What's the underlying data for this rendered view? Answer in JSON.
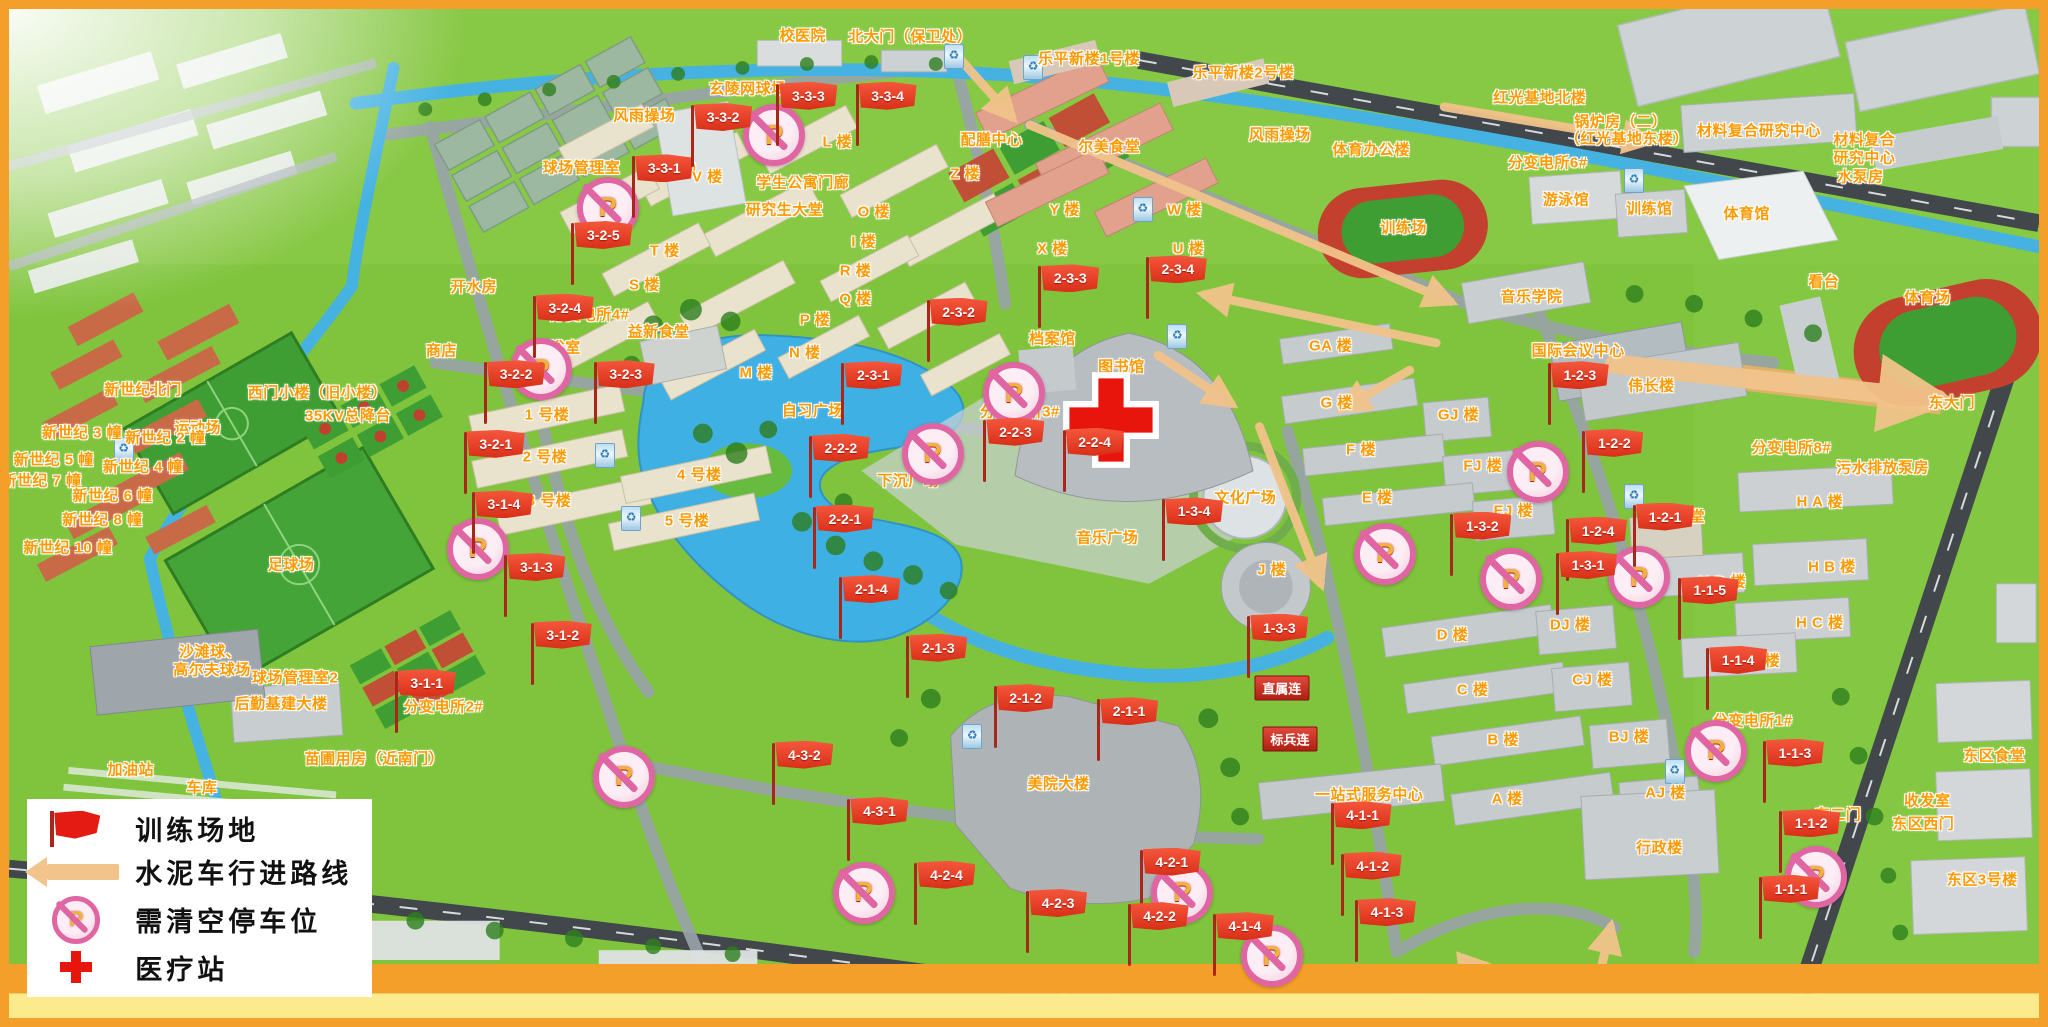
{
  "legend": {
    "items": [
      {
        "icon": "flag-icon",
        "label": "训练场地"
      },
      {
        "icon": "arrow-icon",
        "label": "水泥车行进路线"
      },
      {
        "icon": "no-parking-icon",
        "label": "需清空停车位"
      },
      {
        "icon": "medical-cross-icon",
        "label": "医疗站"
      }
    ]
  },
  "colors": {
    "flag_red": "#e0371f",
    "arrow_tan": "#f2c38b",
    "no_parking_pink": "#df66a2",
    "medical_red": "#e8150d",
    "label_orange": "#ff9a00",
    "frame_orange": "#f59f2b"
  },
  "map": {
    "flags": [
      {
        "id": "3-3-1",
        "x": 30.9,
        "y": 15.9
      },
      {
        "id": "3-3-2",
        "x": 33.8,
        "y": 10.8
      },
      {
        "id": "3-3-3",
        "x": 38.0,
        "y": 8.7
      },
      {
        "id": "3-3-4",
        "x": 41.9,
        "y": 8.7
      },
      {
        "id": "3-2-1",
        "x": 22.6,
        "y": 43.2
      },
      {
        "id": "3-2-2",
        "x": 23.6,
        "y": 36.3
      },
      {
        "id": "3-2-3",
        "x": 29.0,
        "y": 36.3
      },
      {
        "id": "3-2-4",
        "x": 26.0,
        "y": 29.7
      },
      {
        "id": "3-2-5",
        "x": 27.9,
        "y": 22.5
      },
      {
        "id": "3-1-1",
        "x": 19.2,
        "y": 66.9
      },
      {
        "id": "3-1-2",
        "x": 25.9,
        "y": 62.1
      },
      {
        "id": "3-1-3",
        "x": 24.6,
        "y": 55.4
      },
      {
        "id": "3-1-4",
        "x": 23.0,
        "y": 49.2
      },
      {
        "id": "2-3-1",
        "x": 41.2,
        "y": 36.4
      },
      {
        "id": "2-3-2",
        "x": 45.4,
        "y": 30.1
      },
      {
        "id": "2-3-3",
        "x": 50.9,
        "y": 26.8
      },
      {
        "id": "2-3-4",
        "x": 56.2,
        "y": 25.9
      },
      {
        "id": "2-2-1",
        "x": 39.8,
        "y": 50.6
      },
      {
        "id": "2-2-2",
        "x": 39.6,
        "y": 43.6
      },
      {
        "id": "2-2-3",
        "x": 48.2,
        "y": 42.0
      },
      {
        "id": "2-2-4",
        "x": 52.1,
        "y": 43.0
      },
      {
        "id": "2-1-1",
        "x": 53.8,
        "y": 69.7
      },
      {
        "id": "2-1-2",
        "x": 48.7,
        "y": 68.4
      },
      {
        "id": "2-1-3",
        "x": 44.4,
        "y": 63.4
      },
      {
        "id": "2-1-4",
        "x": 41.1,
        "y": 57.6
      },
      {
        "id": "1-2-1",
        "x": 80.2,
        "y": 50.4
      },
      {
        "id": "1-2-2",
        "x": 77.7,
        "y": 43.1
      },
      {
        "id": "1-2-3",
        "x": 76.0,
        "y": 36.4
      },
      {
        "id": "1-2-4",
        "x": 76.9,
        "y": 51.8
      },
      {
        "id": "1-3-1",
        "x": 76.4,
        "y": 55.2
      },
      {
        "id": "1-3-2",
        "x": 71.2,
        "y": 51.3
      },
      {
        "id": "1-3-3",
        "x": 61.2,
        "y": 61.4
      },
      {
        "id": "1-3-4",
        "x": 57.0,
        "y": 49.9
      },
      {
        "id": "1-1-1",
        "x": 86.4,
        "y": 87.3
      },
      {
        "id": "1-1-2",
        "x": 87.4,
        "y": 80.8
      },
      {
        "id": "1-1-3",
        "x": 86.6,
        "y": 73.8
      },
      {
        "id": "1-1-4",
        "x": 83.8,
        "y": 64.6
      },
      {
        "id": "1-1-5",
        "x": 82.4,
        "y": 57.7
      },
      {
        "id": "4-1-1",
        "x": 65.3,
        "y": 80.0
      },
      {
        "id": "4-1-2",
        "x": 65.8,
        "y": 85.0
      },
      {
        "id": "4-1-3",
        "x": 66.5,
        "y": 89.6
      },
      {
        "id": "4-1-4",
        "x": 59.5,
        "y": 91.0
      },
      {
        "id": "4-2-1",
        "x": 55.9,
        "y": 84.6
      },
      {
        "id": "4-2-2",
        "x": 55.3,
        "y": 90.0
      },
      {
        "id": "4-2-3",
        "x": 50.3,
        "y": 88.7
      },
      {
        "id": "4-2-4",
        "x": 44.8,
        "y": 85.9
      },
      {
        "id": "4-3-1",
        "x": 41.5,
        "y": 79.6
      },
      {
        "id": "4-3-2",
        "x": 37.8,
        "y": 74.0
      }
    ],
    "labels": [
      {
        "text": "校医院",
        "x": 39.1,
        "y": 2.6
      },
      {
        "text": "北大门（保卫处）",
        "x": 44.4,
        "y": 2.7
      },
      {
        "text": "乐平新楼1号楼",
        "x": 53.2,
        "y": 4.9
      },
      {
        "text": "乐平新楼2号楼",
        "x": 60.8,
        "y": 6.2
      },
      {
        "text": "红光基地北楼",
        "x": 75.4,
        "y": 8.7
      },
      {
        "text": "锅炉房（二）",
        "x": 79.4,
        "y": 11.1
      },
      {
        "text": "（红光基地东楼）",
        "x": 79.7,
        "y": 12.8
      },
      {
        "text": "材料复合研究中心",
        "x": 86.2,
        "y": 12.0
      },
      {
        "text": "材料复合",
        "x": 91.4,
        "y": 12.9
      },
      {
        "text": "研究中心",
        "x": 91.4,
        "y": 14.7
      },
      {
        "text": "水泵房",
        "x": 91.2,
        "y": 16.6
      },
      {
        "text": "玄陵网球场",
        "x": 36.4,
        "y": 7.8
      },
      {
        "text": "水泵房",
        "x": 39.3,
        "y": 8.6
      },
      {
        "text": "2#",
        "x": 43.0,
        "y": 8.4
      },
      {
        "text": "风雨操场",
        "x": 31.3,
        "y": 10.5
      },
      {
        "text": "风雨操场",
        "x": 62.6,
        "y": 12.4
      },
      {
        "text": "体育办公楼",
        "x": 67.1,
        "y": 13.9
      },
      {
        "text": "配膳中心",
        "x": 48.4,
        "y": 12.9
      },
      {
        "text": "尔美食堂",
        "x": 54.2,
        "y": 13.6
      },
      {
        "text": "训练场",
        "x": 68.7,
        "y": 21.6
      },
      {
        "text": "游泳馆",
        "x": 76.7,
        "y": 18.8
      },
      {
        "text": "训练馆",
        "x": 80.8,
        "y": 19.7
      },
      {
        "text": "体育馆",
        "x": 85.6,
        "y": 20.2
      },
      {
        "text": "看台",
        "x": 89.4,
        "y": 27.0
      },
      {
        "text": "体育场",
        "x": 94.5,
        "y": 28.5
      },
      {
        "text": "分变电所6#",
        "x": 75.8,
        "y": 15.2
      },
      {
        "text": "学生公寓门廊",
        "x": 39.1,
        "y": 17.1
      },
      {
        "text": "研究生大堂",
        "x": 38.2,
        "y": 19.8
      },
      {
        "text": "球场管理室",
        "x": 28.2,
        "y": 15.7
      },
      {
        "text": "（球馆）",
        "x": 32.8,
        "y": 15.8
      },
      {
        "text": "开水房",
        "x": 22.9,
        "y": 27.5
      },
      {
        "text": "分变电所4#",
        "x": 28.6,
        "y": 30.2
      },
      {
        "text": "商店",
        "x": 21.3,
        "y": 33.8
      },
      {
        "text": "浴室",
        "x": 27.4,
        "y": 33.5
      },
      {
        "text": "益新食堂",
        "x": 32.0,
        "y": 31.9
      },
      {
        "text": "L 楼",
        "x": 40.8,
        "y": 13.1
      },
      {
        "text": "V 楼",
        "x": 34.4,
        "y": 16.6
      },
      {
        "text": "Z 楼",
        "x": 47.1,
        "y": 16.3
      },
      {
        "text": "Y 楼",
        "x": 52.0,
        "y": 19.8
      },
      {
        "text": "X 楼",
        "x": 51.4,
        "y": 23.7
      },
      {
        "text": "W 楼",
        "x": 57.9,
        "y": 19.8
      },
      {
        "text": "U 楼",
        "x": 58.1,
        "y": 23.7
      },
      {
        "text": "O 楼",
        "x": 42.6,
        "y": 20.0
      },
      {
        "text": "I 楼",
        "x": 42.1,
        "y": 23.0
      },
      {
        "text": "R 楼",
        "x": 41.7,
        "y": 25.9
      },
      {
        "text": "Q 楼",
        "x": 41.7,
        "y": 28.6
      },
      {
        "text": "P 楼",
        "x": 39.7,
        "y": 30.7
      },
      {
        "text": "N 楼",
        "x": 39.2,
        "y": 34.0
      },
      {
        "text": "M 楼",
        "x": 36.8,
        "y": 36.0
      },
      {
        "text": "T 楼",
        "x": 32.3,
        "y": 23.9
      },
      {
        "text": "S 楼",
        "x": 31.3,
        "y": 27.3
      },
      {
        "text": "1 号楼",
        "x": 26.5,
        "y": 40.1
      },
      {
        "text": "2 号楼",
        "x": 26.4,
        "y": 44.3
      },
      {
        "text": "3 号楼",
        "x": 26.6,
        "y": 48.7
      },
      {
        "text": "4 号楼",
        "x": 34.0,
        "y": 46.1
      },
      {
        "text": "5 号楼",
        "x": 33.4,
        "y": 50.6
      },
      {
        "text": "档案馆",
        "x": 51.4,
        "y": 32.6
      },
      {
        "text": "图书馆",
        "x": 54.8,
        "y": 35.4
      },
      {
        "text": "分变电所3#",
        "x": 49.8,
        "y": 39.8
      },
      {
        "text": "下沉广场",
        "x": 44.3,
        "y": 46.7
      },
      {
        "text": "文化广场",
        "x": 60.9,
        "y": 48.4
      },
      {
        "text": "音乐广场",
        "x": 54.1,
        "y": 52.3
      },
      {
        "text": "自习广场",
        "x": 39.6,
        "y": 39.7
      },
      {
        "text": "美院大楼",
        "x": 51.7,
        "y": 76.7
      },
      {
        "text": "一站式服务中心",
        "x": 67.0,
        "y": 77.8
      },
      {
        "text": "A 楼",
        "x": 73.8,
        "y": 78.2
      },
      {
        "text": "AJ 楼",
        "x": 81.6,
        "y": 77.6
      },
      {
        "text": "B 楼",
        "x": 73.6,
        "y": 72.3
      },
      {
        "text": "BJ 楼",
        "x": 79.8,
        "y": 72.1
      },
      {
        "text": "C 楼",
        "x": 72.1,
        "y": 67.4
      },
      {
        "text": "CJ 楼",
        "x": 78.0,
        "y": 66.4
      },
      {
        "text": "D 楼",
        "x": 71.1,
        "y": 61.9
      },
      {
        "text": "DJ 楼",
        "x": 76.9,
        "y": 61.0
      },
      {
        "text": "E 楼",
        "x": 67.4,
        "y": 48.4
      },
      {
        "text": "EJ 楼",
        "x": 74.1,
        "y": 49.7
      },
      {
        "text": "F 楼",
        "x": 66.6,
        "y": 43.6
      },
      {
        "text": "FJ 楼",
        "x": 72.6,
        "y": 45.2
      },
      {
        "text": "G 楼",
        "x": 65.4,
        "y": 38.9
      },
      {
        "text": "GJ 楼",
        "x": 71.4,
        "y": 40.1
      },
      {
        "text": "GA 楼",
        "x": 65.1,
        "y": 33.3
      },
      {
        "text": "J 楼",
        "x": 62.2,
        "y": 55.5
      },
      {
        "text": "音乐学院",
        "x": 75.0,
        "y": 28.4
      },
      {
        "text": "国际会议中心",
        "x": 77.3,
        "y": 33.8
      },
      {
        "text": "伟长楼",
        "x": 80.9,
        "y": 37.3
      },
      {
        "text": "东大门",
        "x": 95.7,
        "y": 38.9
      },
      {
        "text": "分变电所8#",
        "x": 87.8,
        "y": 43.4
      },
      {
        "text": "污水排放泵房",
        "x": 92.3,
        "y": 45.4
      },
      {
        "text": "H A 楼",
        "x": 89.2,
        "y": 48.8
      },
      {
        "text": "H B 楼",
        "x": 89.8,
        "y": 55.2
      },
      {
        "text": "H C 楼",
        "x": 89.2,
        "y": 60.8
      },
      {
        "text": "H D 楼",
        "x": 84.4,
        "y": 56.7
      },
      {
        "text": "H E 楼",
        "x": 86.1,
        "y": 64.5
      },
      {
        "text": "秀食堂",
        "x": 82.4,
        "y": 50.2
      },
      {
        "text": "行政楼",
        "x": 81.3,
        "y": 83.1
      },
      {
        "text": "东二门",
        "x": 90.1,
        "y": 79.8
      },
      {
        "text": "收发室",
        "x": 94.5,
        "y": 78.4
      },
      {
        "text": "东区西门",
        "x": 94.3,
        "y": 80.7
      },
      {
        "text": "东区食堂",
        "x": 97.8,
        "y": 73.9
      },
      {
        "text": "东区3号楼",
        "x": 97.2,
        "y": 86.2
      },
      {
        "text": "分变电所1#",
        "x": 85.9,
        "y": 70.5
      },
      {
        "text": "苗圃用房（近南门）",
        "x": 18.0,
        "y": 74.2
      },
      {
        "text": "加油站",
        "x": 6.0,
        "y": 75.3
      },
      {
        "text": "车库",
        "x": 9.5,
        "y": 77.1
      },
      {
        "text": "后勤基建大楼",
        "x": 13.4,
        "y": 68.8
      },
      {
        "text": "球场管理室2",
        "x": 14.1,
        "y": 66.2
      },
      {
        "text": "沙滩球、",
        "x": 9.9,
        "y": 63.6
      },
      {
        "text": "高尔夫球场",
        "x": 10.0,
        "y": 65.4
      },
      {
        "text": "足球场",
        "x": 13.9,
        "y": 55.0
      },
      {
        "text": "运动场",
        "x": 9.3,
        "y": 41.4
      },
      {
        "text": "分变电所2#",
        "x": 21.4,
        "y": 69.1
      },
      {
        "text": "西门小楼（旧小楼）",
        "x": 15.2,
        "y": 38.0
      },
      {
        "text": "35KV总降台",
        "x": 16.7,
        "y": 40.2
      },
      {
        "text": "新世纪北门",
        "x": 6.6,
        "y": 37.7
      },
      {
        "text": "新世纪 3 幢",
        "x": 3.6,
        "y": 41.9
      },
      {
        "text": "新世纪 2 幢",
        "x": 7.7,
        "y": 42.4
      },
      {
        "text": "新世纪 5 幢",
        "x": 2.2,
        "y": 44.6
      },
      {
        "text": "新世纪 4 幢",
        "x": 6.6,
        "y": 45.3
      },
      {
        "text": "新世纪 7 幢",
        "x": 1.6,
        "y": 46.7
      },
      {
        "text": "新世纪 6 幢",
        "x": 5.1,
        "y": 48.2
      },
      {
        "text": "新世纪 8 幢",
        "x": 4.6,
        "y": 50.5
      },
      {
        "text": "新世纪 10 幢",
        "x": 2.9,
        "y": 53.3
      }
    ],
    "signs": [
      {
        "text": "直属连",
        "x": 62.7,
        "y": 67.3
      },
      {
        "text": "标兵连",
        "x": 63.1,
        "y": 72.3
      }
    ],
    "no_parking": [
      {
        "x": 37.4,
        "y": 11.9
      },
      {
        "x": 29.2,
        "y": 19.1
      },
      {
        "x": 25.9,
        "y": 35.1
      },
      {
        "x": 22.8,
        "y": 52.9
      },
      {
        "x": 30.0,
        "y": 75.5
      },
      {
        "x": 49.2,
        "y": 37.5
      },
      {
        "x": 45.2,
        "y": 43.5
      },
      {
        "x": 67.5,
        "y": 53.4
      },
      {
        "x": 75.0,
        "y": 45.3
      },
      {
        "x": 73.7,
        "y": 55.9
      },
      {
        "x": 80.0,
        "y": 55.7
      },
      {
        "x": 83.8,
        "y": 72.9
      },
      {
        "x": 88.7,
        "y": 85.4
      },
      {
        "x": 57.5,
        "y": 87.0
      },
      {
        "x": 61.9,
        "y": 93.3
      },
      {
        "x": 41.8,
        "y": 87.0
      }
    ],
    "medical": [
      {
        "x": 54.3,
        "y": 40.7
      }
    ],
    "kiosks": [
      {
        "x": 46.5,
        "y": 4.6
      },
      {
        "x": 50.4,
        "y": 5.6
      },
      {
        "x": 55.8,
        "y": 19.7
      },
      {
        "x": 57.5,
        "y": 32.3
      },
      {
        "x": 80.0,
        "y": 16.8
      },
      {
        "x": 5.6,
        "y": 43.5
      },
      {
        "x": 29.3,
        "y": 44.1
      },
      {
        "x": 30.6,
        "y": 50.3
      },
      {
        "x": 47.4,
        "y": 72.0
      },
      {
        "x": 80.0,
        "y": 48.2
      },
      {
        "x": 82.0,
        "y": 75.4
      }
    ],
    "kiosk_glyph": "♻",
    "arrows": [
      {
        "x1": 46.6,
        "y1": 4.4,
        "x2": 49.4,
        "y2": 10.7
      },
      {
        "x1": 50.3,
        "y1": 11.5,
        "x2": 71.0,
        "y2": 29.0
      },
      {
        "x1": 70.7,
        "y1": 9.7,
        "x2": 80.8,
        "y2": 13.1
      },
      {
        "x1": 70.3,
        "y1": 33.1,
        "x2": 58.9,
        "y2": 28.3
      },
      {
        "x1": 69.0,
        "y1": 35.8,
        "x2": 65.7,
        "y2": 39.6
      },
      {
        "x1": 56.6,
        "y1": 34.3,
        "x2": 60.2,
        "y2": 39.1
      },
      {
        "x1": 61.6,
        "y1": 41.4,
        "x2": 64.6,
        "y2": 56.9
      },
      {
        "x1": 67.9,
        "y1": 98.5,
        "x2": 70.0,
        "y2": 95.9
      },
      {
        "x1": 70.3,
        "y1": 95.4,
        "x2": 72.7,
        "y2": 94.8
      },
      {
        "x1": 78.3,
        "y1": 96.2,
        "x2": 78.9,
        "y2": 91.0
      },
      {
        "x1": 79.1,
        "y1": 35.2,
        "x2": 95.0,
        "y2": 38.7,
        "wide": true
      }
    ]
  }
}
